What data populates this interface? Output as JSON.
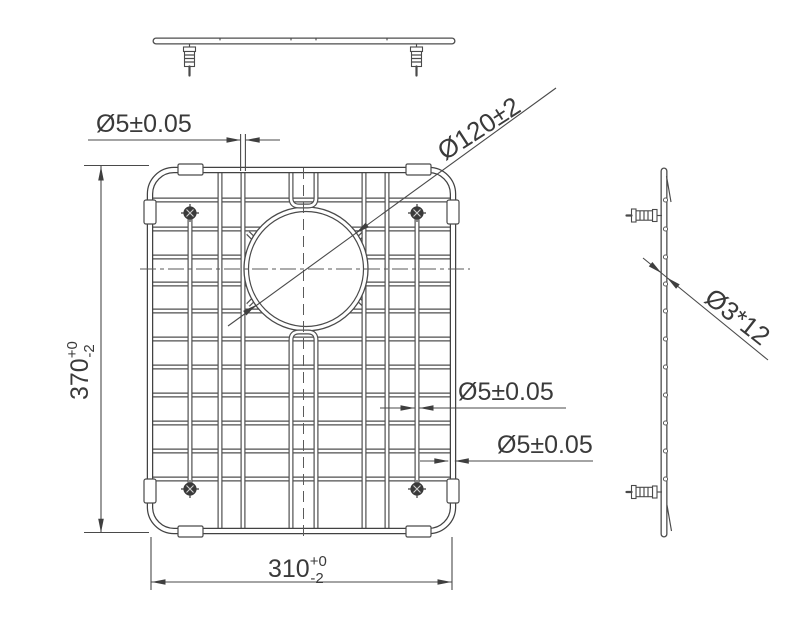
{
  "drawing": {
    "background": "#ffffff",
    "line_color": "#4a4a4a",
    "text_color": "#3a3a3a",
    "dims": {
      "wire_top": "Ø5±0.05",
      "hole": "Ø120±2",
      "wire_mid": "Ø5±0.05",
      "rim": "Ø5±0.05",
      "pin": "Ø3*12",
      "height": {
        "value": "370",
        "plus": "+0",
        "minus": "-2"
      },
      "width": {
        "value": "310",
        "plus": "+0",
        "minus": "-2"
      }
    }
  }
}
